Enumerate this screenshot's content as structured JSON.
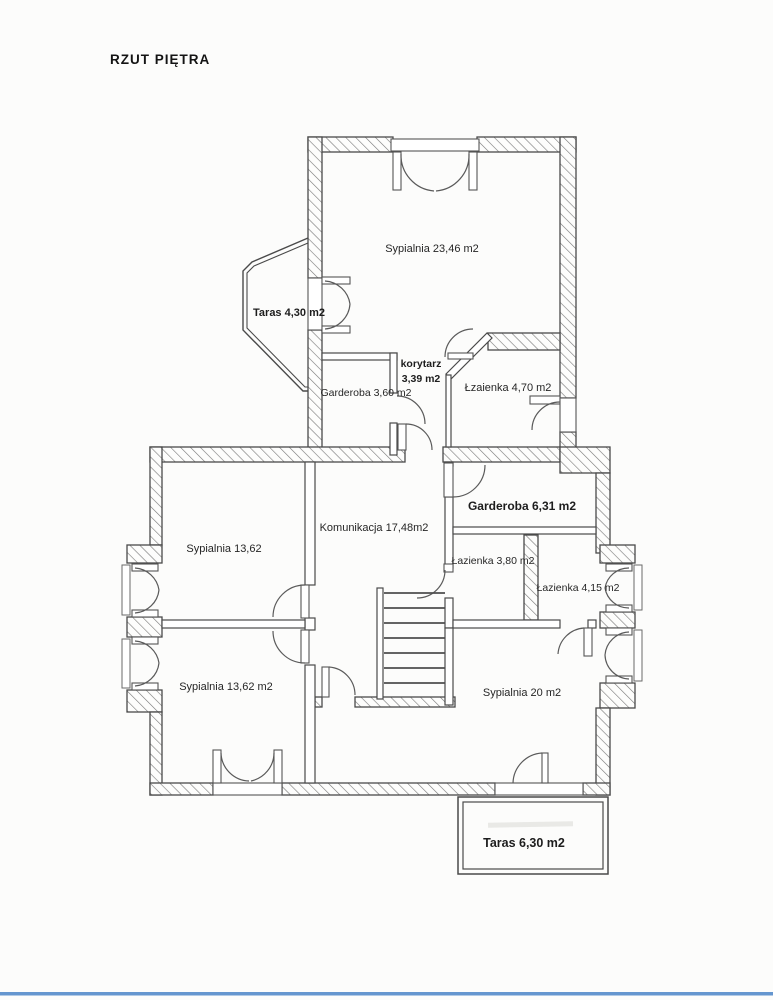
{
  "page": {
    "title": "RZUT PIĘTRA",
    "scan_accent_color": "#6596cf"
  },
  "rooms": {
    "sypialnia_top": "Sypialnia 23,46 m2",
    "taras_left": "Taras 4,30 m2",
    "garderoba_small": "Garderoba 3,60 m2",
    "korytarz_name": "korytarz",
    "korytarz_area": "3,39 m2",
    "lazienka_top": "Łzaienka 4,70 m2",
    "garderoba_big": "Garderoba 6,31 m2",
    "sypialnia_mid": "Sypialnia 13,62",
    "komunikacja": "Komunikacja 17,48m2",
    "lazienka_380": "Łazienka 3,80 m2",
    "lazienka_415": "Łazienka 4,15 m2",
    "sypialnia_bottom": "Sypialnia 13,62 m2",
    "sypialnia_20": "Sypialnia 20 m2",
    "taras_bottom": "Taras 6,30 m2"
  }
}
